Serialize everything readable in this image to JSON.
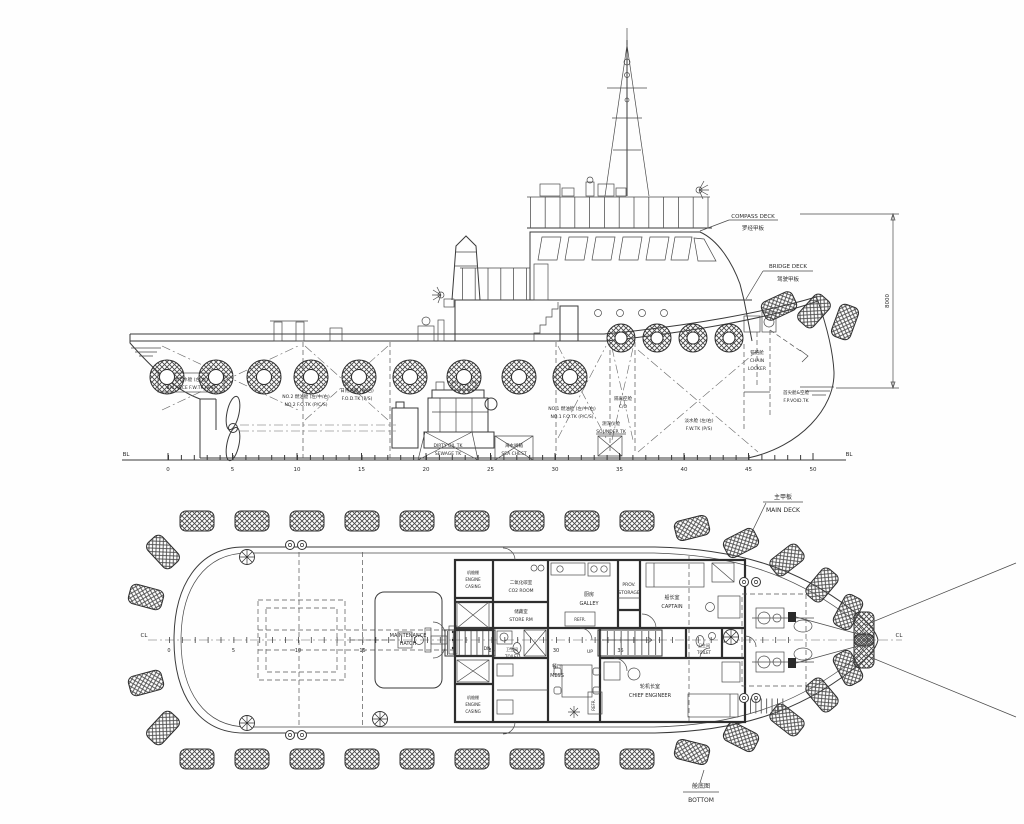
{
  "profile": {
    "compass_deck": {
      "en": "COMPASS DECK",
      "zh": "罗经甲板"
    },
    "bridge_deck": {
      "en": "BRIDGE DECK",
      "zh": "驾驶甲板"
    },
    "chain_locker": {
      "zh": "锚链舱",
      "en1": "CHAIN",
      "en2": "LOCKER"
    },
    "fp_void": {
      "zh": "首尖舱&空舱",
      "en": "F.P.VOID.TK"
    },
    "balance_fw": {
      "zh": "调节水舱 (左/右)",
      "en": "BALANCE F.W.TK (P/S)"
    },
    "no2_fo": {
      "zh": "NO.2 燃油舱 (左/中/右)",
      "en": "NO.2 F.O.TK (P/C/S)"
    },
    "fod": {
      "zh": "日用油舱 (左/右)",
      "en": "F.O.D.TK (P/S)"
    },
    "dirty_oil": {
      "l1": "DIRTY OIL TK",
      "l2": "SEWAGE TK"
    },
    "sea_chest": {
      "zh": "海水阀箱",
      "en": "SEA CHEST"
    },
    "no1_fo": {
      "zh": "NO.1 燃油舱 (左/中/右)",
      "en": "NO.1 F.O.TK (P/C/S)"
    },
    "cofferdam": {
      "zh": "隔离空舱",
      "en": "C/O"
    },
    "sounder": {
      "zh": "测深仪舱",
      "en": "SOUNDER TK"
    },
    "fw_tk": {
      "zh": "淡水舱 (左/右)",
      "en": "F.W.TK (P/S)"
    },
    "dim_height": "8000",
    "bl_left": "BL",
    "bl_right": "BL",
    "ticks": [
      "0",
      "5",
      "10",
      "15",
      "20",
      "25",
      "30",
      "35",
      "40",
      "45",
      "50"
    ]
  },
  "plan": {
    "main_deck": {
      "zh": "主甲板",
      "en": "MAIN DECK"
    },
    "bottom": {
      "zh": "舱底图",
      "en": "BOTTOM"
    },
    "cl_left": "CL",
    "cl_right": "CL",
    "ticks": [
      "0",
      "5",
      "10",
      "15",
      "25",
      "30",
      "35"
    ],
    "rooms": {
      "maintenance": {
        "l1": "MAINTENANCE",
        "l2": "HATCH"
      },
      "engine_casing": {
        "zh": "机舱棚",
        "en1": "ENGINE",
        "en2": "CASING"
      },
      "co2": {
        "zh": "二氧化碳室",
        "en": "CO2 ROOM"
      },
      "store": {
        "zh": "储藏室",
        "en": "STORE RM"
      },
      "galley": {
        "zh": "厨房",
        "en": "GALLEY"
      },
      "refr": "REFR.",
      "prov": {
        "l1": "PROV.",
        "l2": "STORAGE"
      },
      "captain": {
        "zh": "船长室",
        "en": "CAPTAIN"
      },
      "toilet": {
        "zh": "卫生间",
        "en": "TOILET"
      },
      "mess": {
        "zh": "餐厅",
        "en": "MESS"
      },
      "chief": {
        "zh": "轮机长室",
        "en": "CHIEF ENGINEER"
      },
      "up": "UP",
      "dn": "DN"
    }
  }
}
